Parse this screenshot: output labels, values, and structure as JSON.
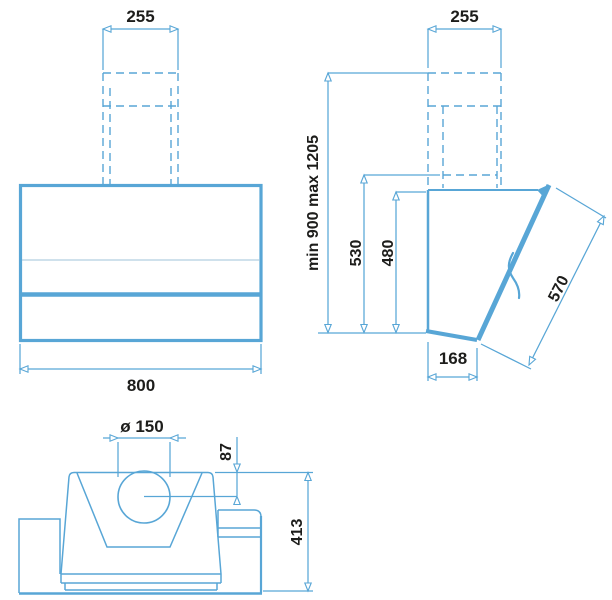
{
  "views": {
    "front": {
      "dimensions": {
        "chimney_width": "255",
        "body_width": "800"
      }
    },
    "side": {
      "dimensions": {
        "chimney_width": "255",
        "mounting_height": "min 900  max 1205",
        "chimney_height": "530",
        "body_height": "480",
        "glass_panel_length": "570",
        "bottom_depth": "168"
      }
    },
    "top": {
      "dimensions": {
        "duct_diameter": "ø 150",
        "duct_center_offset": "87",
        "body_depth": "413"
      }
    }
  },
  "colors": {
    "line": "#58a6d6",
    "thin_line": "#9fc3d8",
    "text": "#1d1d1b",
    "background": "#ffffff"
  }
}
